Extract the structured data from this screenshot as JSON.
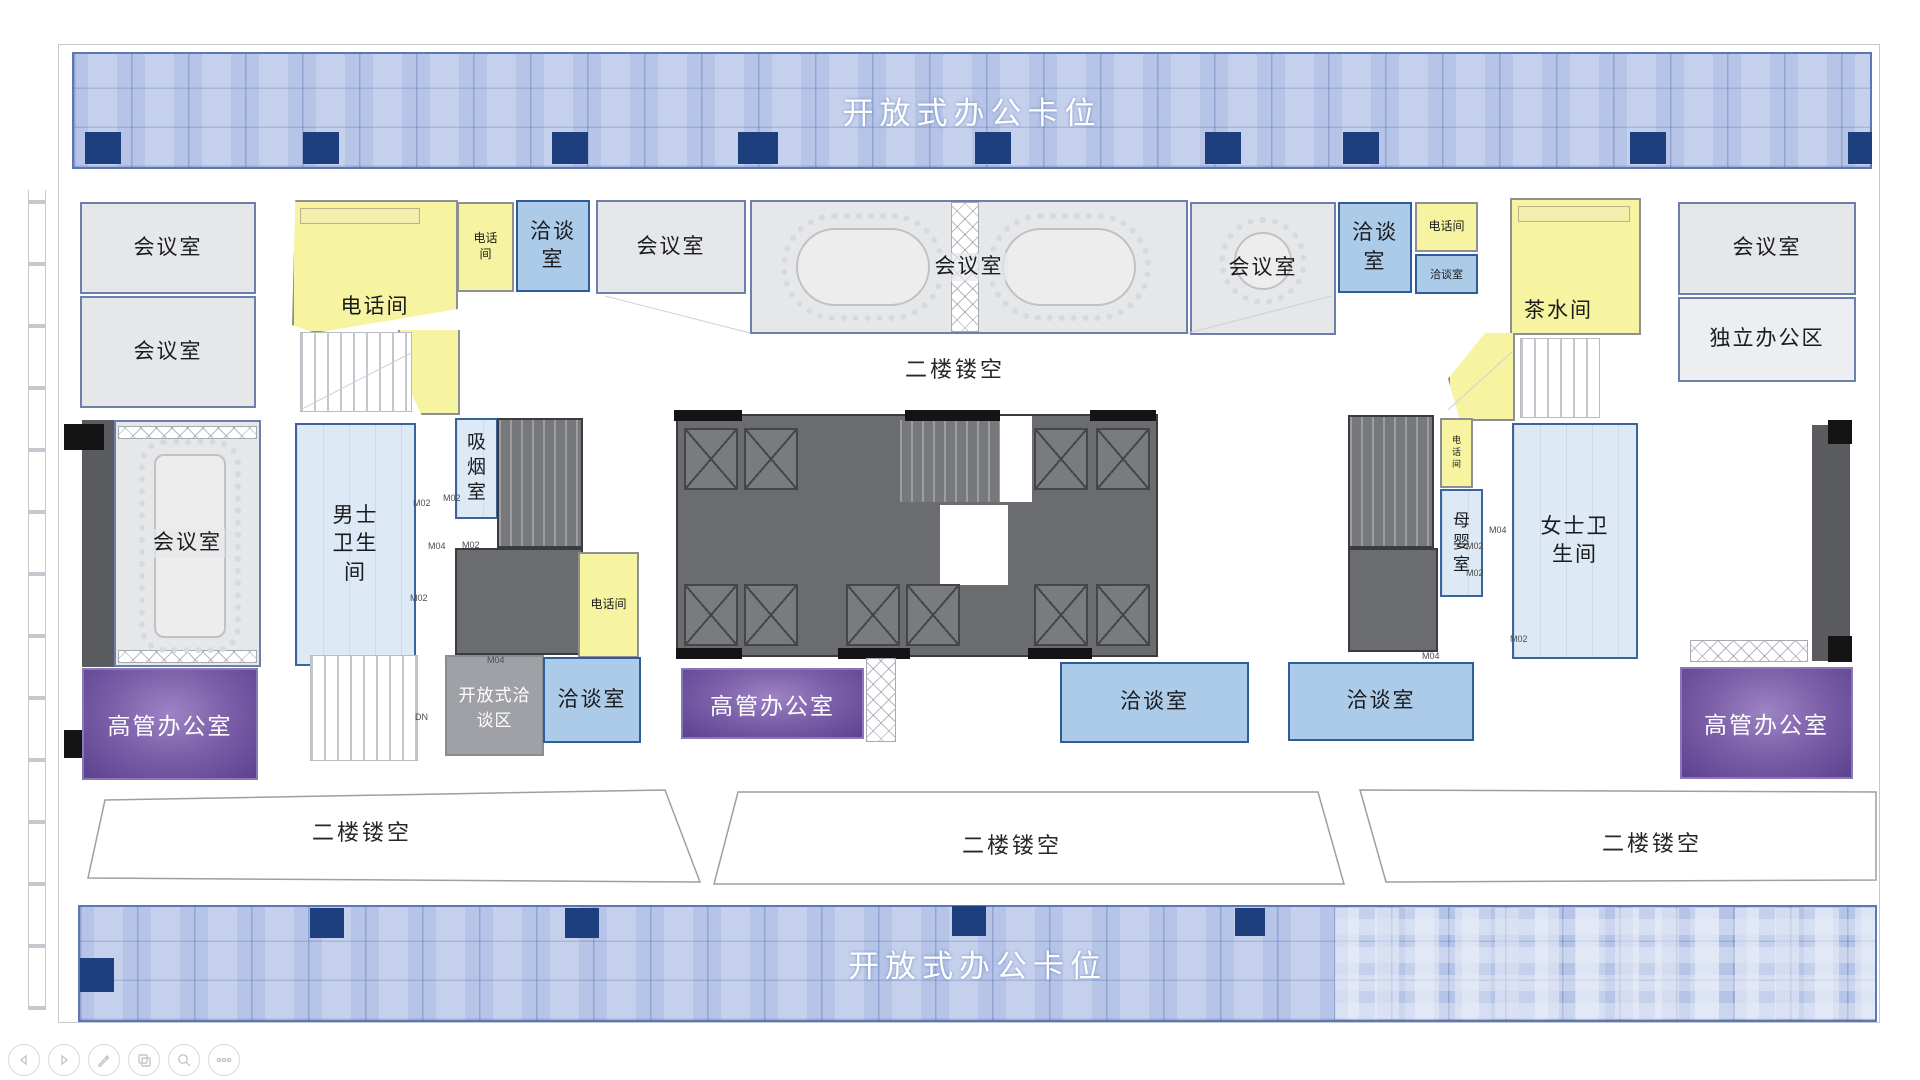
{
  "bands": {
    "top": "开放式办公卡位",
    "bottom": "开放式办公卡位"
  },
  "voids": {
    "top_center": "二楼镂空",
    "bottom_left": "二楼镂空",
    "bottom_center": "二楼镂空",
    "bottom_right": "二楼镂空"
  },
  "rooms": [
    {
      "name": "meeting-room-top-left-1",
      "label": "会议室"
    },
    {
      "name": "meeting-room-top-left-2",
      "label": "会议室"
    },
    {
      "name": "phone-zone-top-left",
      "label": "电话间"
    },
    {
      "name": "phone-booth-top-left",
      "label": "电话间"
    },
    {
      "name": "negotiation-room-top-left",
      "label": "洽谈室"
    },
    {
      "name": "meeting-room-top-mid-left",
      "label": "会议室"
    },
    {
      "name": "meeting-room-top-center",
      "label": "会议室"
    },
    {
      "name": "meeting-room-top-mid-right",
      "label": "会议室"
    },
    {
      "name": "negotiation-room-top-right",
      "label": "洽谈室"
    },
    {
      "name": "phone-booth-top-right",
      "label": "电话间"
    },
    {
      "name": "negotiation-room-small-top-right",
      "label": "洽谈室"
    },
    {
      "name": "pantry",
      "label": "茶水间"
    },
    {
      "name": "meeting-room-right",
      "label": "会议室"
    },
    {
      "name": "private-office-area",
      "label": "独立办公区"
    },
    {
      "name": "meeting-room-mid-left",
      "label": "会议室"
    },
    {
      "name": "mens-restroom",
      "label": "男士卫生间"
    },
    {
      "name": "smoking-room",
      "label": "吸烟室"
    },
    {
      "name": "phone-booth-mid-left",
      "label": "电话间"
    },
    {
      "name": "phone-booth-mid-right",
      "label": "电话间"
    },
    {
      "name": "nursing-room",
      "label": "母婴室"
    },
    {
      "name": "womens-restroom",
      "label": "女士卫生间"
    },
    {
      "name": "executive-office-left",
      "label": "高管办公室"
    },
    {
      "name": "open-negotiation-area",
      "label": "开放式洽谈区"
    },
    {
      "name": "negotiation-room-bottom-1",
      "label": "洽谈室"
    },
    {
      "name": "executive-office-mid",
      "label": "高管办公室"
    },
    {
      "name": "negotiation-room-bottom-2",
      "label": "洽谈室"
    },
    {
      "name": "negotiation-room-bottom-3",
      "label": "洽谈室"
    },
    {
      "name": "executive-office-right",
      "label": "高管办公室"
    }
  ],
  "door_tags": [
    {
      "text": "M02"
    },
    {
      "text": "M02"
    },
    {
      "text": "M04"
    },
    {
      "text": "M02"
    },
    {
      "text": "M02"
    },
    {
      "text": "M04"
    },
    {
      "text": "M04"
    },
    {
      "text": "M02"
    },
    {
      "text": "M02"
    },
    {
      "text": "M02"
    },
    {
      "text": "M04"
    },
    {
      "text": "DN"
    }
  ],
  "toolbar": {
    "buttons": [
      {
        "name": "back-icon"
      },
      {
        "name": "forward-icon"
      },
      {
        "name": "edit-pencil-icon"
      },
      {
        "name": "copy-layers-icon"
      },
      {
        "name": "zoom-search-icon"
      },
      {
        "name": "more-ellipsis-icon"
      }
    ]
  },
  "colors": {
    "band_blue": "#b5c4e7",
    "navy_accent": "#1e3f7d",
    "room_gray": "#e6e7e9",
    "phone_yellow": "#f7f4a1",
    "negotiation_blue": "#abcbe9",
    "restroom_blue": "#dde9f4",
    "executive_purple": "#6f51a0",
    "core_dark": "#6b6c70"
  }
}
